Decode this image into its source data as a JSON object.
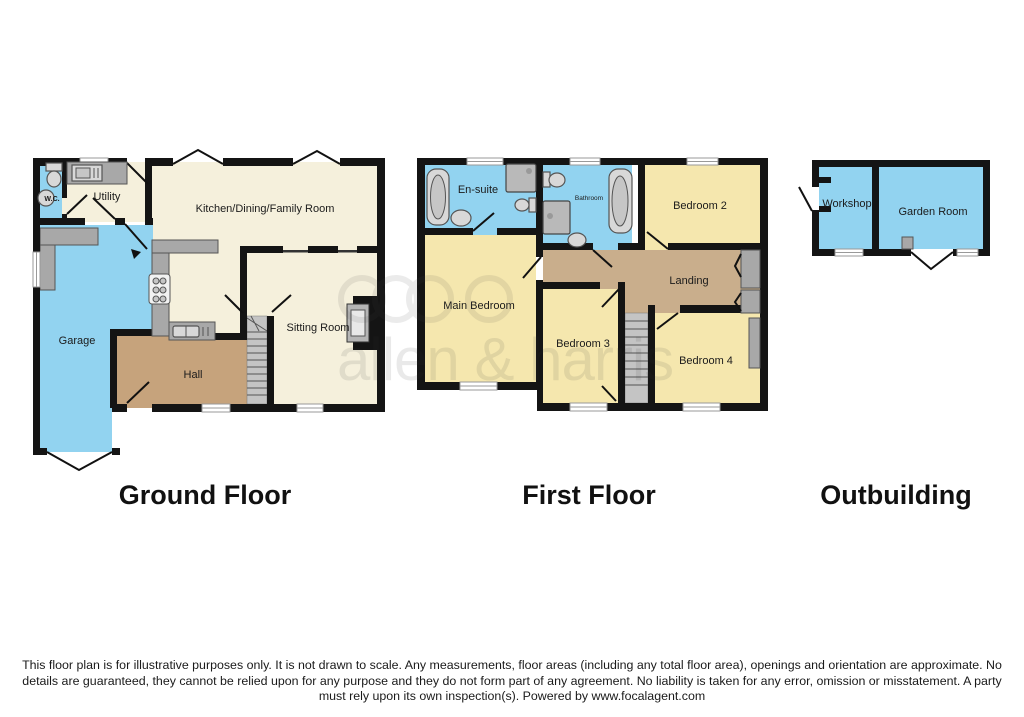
{
  "watermark": {
    "text": "allen & harris"
  },
  "disclaimer": "This floor plan is for illustrative purposes only. It is not drawn to scale. Any measurements, floor areas (including any total floor area), openings and orientation are approximate. No details are guaranteed, they cannot be relied upon for any purpose and they do not form part of any agreement. No liability is taken for any error, omission or misstatement. A party must rely upon its own inspection(s). Powered by www.focalagent.com",
  "colors": {
    "wet_room": "#92d3f0",
    "living": "#f5f0dc",
    "bedroom": "#f5e7ae",
    "hall": "#c6a37c",
    "landing": "#c9ae8c",
    "counter": "#a8a8a8",
    "stairs": "#c4c4c4",
    "wall": "#141414"
  },
  "floors": {
    "ground": {
      "title": "Ground Floor",
      "rooms": {
        "wc": "W.C.",
        "utility": "Utility",
        "kitchen": "Kitchen/Dining/Family Room",
        "garage": "Garage",
        "hall": "Hall",
        "sitting_room": "Sitting Room"
      }
    },
    "first": {
      "title": "First Floor",
      "rooms": {
        "ensuite": "En-suite",
        "bathroom": "Bathroom",
        "bedroom2": "Bedroom 2",
        "main_bedroom": "Main Bedroom",
        "landing": "Landing",
        "bedroom3": "Bedroom 3",
        "bedroom4": "Bedroom 4"
      }
    },
    "outbuilding": {
      "title": "Outbuilding",
      "rooms": {
        "workshop": "Workshop",
        "garden_room": "Garden Room"
      }
    }
  }
}
